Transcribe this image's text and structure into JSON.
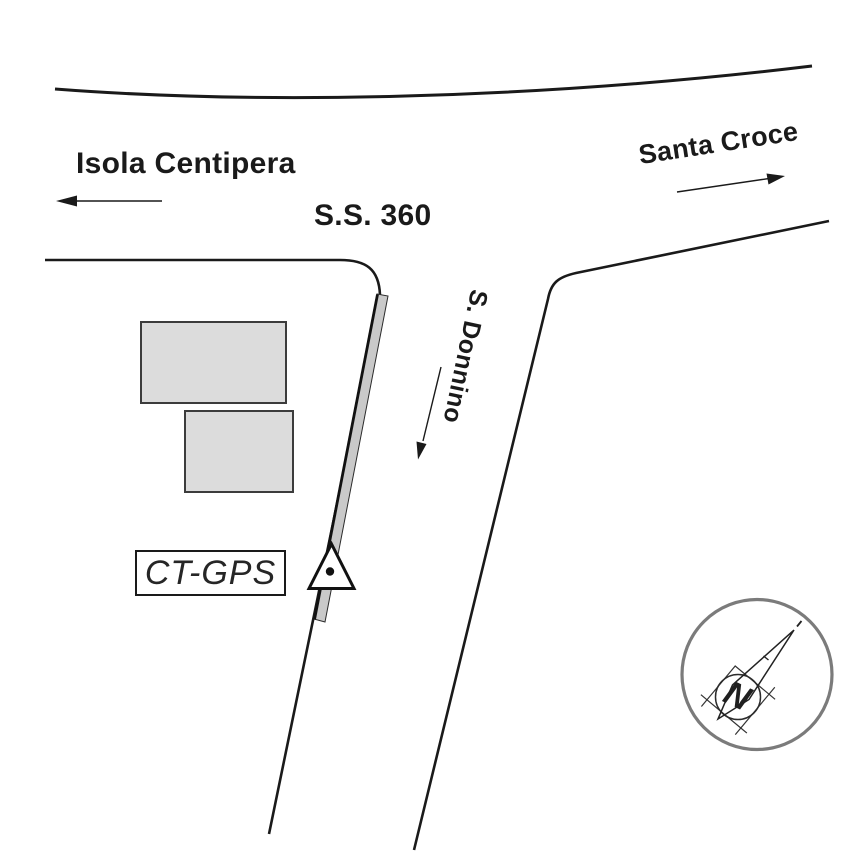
{
  "labels": {
    "destination_west": "Isola Centipera",
    "highway_name": "S.S. 360",
    "destination_east": "Santa Croce",
    "street_name": "S. Donnino",
    "station_label": "CT-GPS",
    "compass_north": "N"
  },
  "icons": {
    "arrow_west": "arrow-west-icon",
    "arrow_east": "arrow-east-icon",
    "arrow_down_street": "arrow-south-icon",
    "station_marker": "triangle-dot-station-icon",
    "compass": "compass-rose-icon"
  },
  "colors": {
    "background": "#ffffff",
    "line": "#1a1a1a",
    "building_fill": "#dcdcdc",
    "building_border": "#3c3c3c",
    "wall_fill": "#c9c9c9",
    "compass_ring": "#7b7b7b",
    "marker_fill": "#ffffff"
  }
}
